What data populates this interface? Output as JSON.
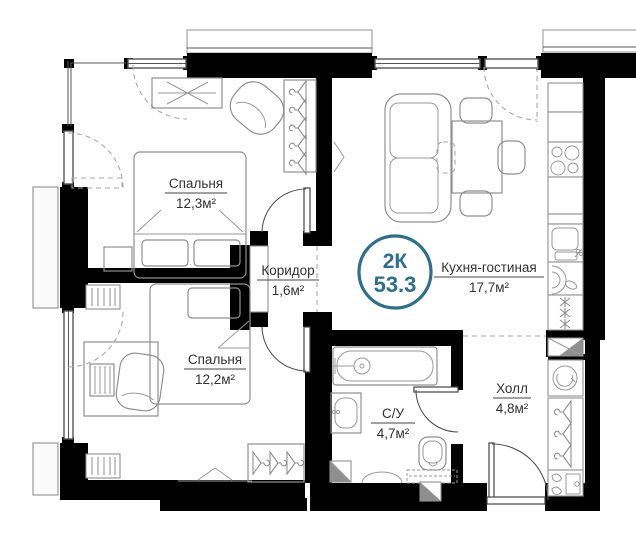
{
  "plan": {
    "badge": {
      "rooms_label": "2К",
      "total_area": "53.3",
      "accent_color": "#2e6f8e"
    },
    "rooms": [
      {
        "name": "Спальня",
        "area": "12,3м²"
      },
      {
        "name": "Коридор",
        "area": "1,6м²"
      },
      {
        "name": "Кухня-гостиная",
        "area": "17,7м²"
      },
      {
        "name": "Спальня",
        "area": "12,2м²"
      },
      {
        "name": "С/У",
        "area": "4,7м²"
      },
      {
        "name": "Холл",
        "area": "4,8м²"
      }
    ],
    "colors": {
      "wall": "#000000",
      "furniture_outline": "#8f8f8f",
      "accent": "#2e6f8e"
    }
  }
}
